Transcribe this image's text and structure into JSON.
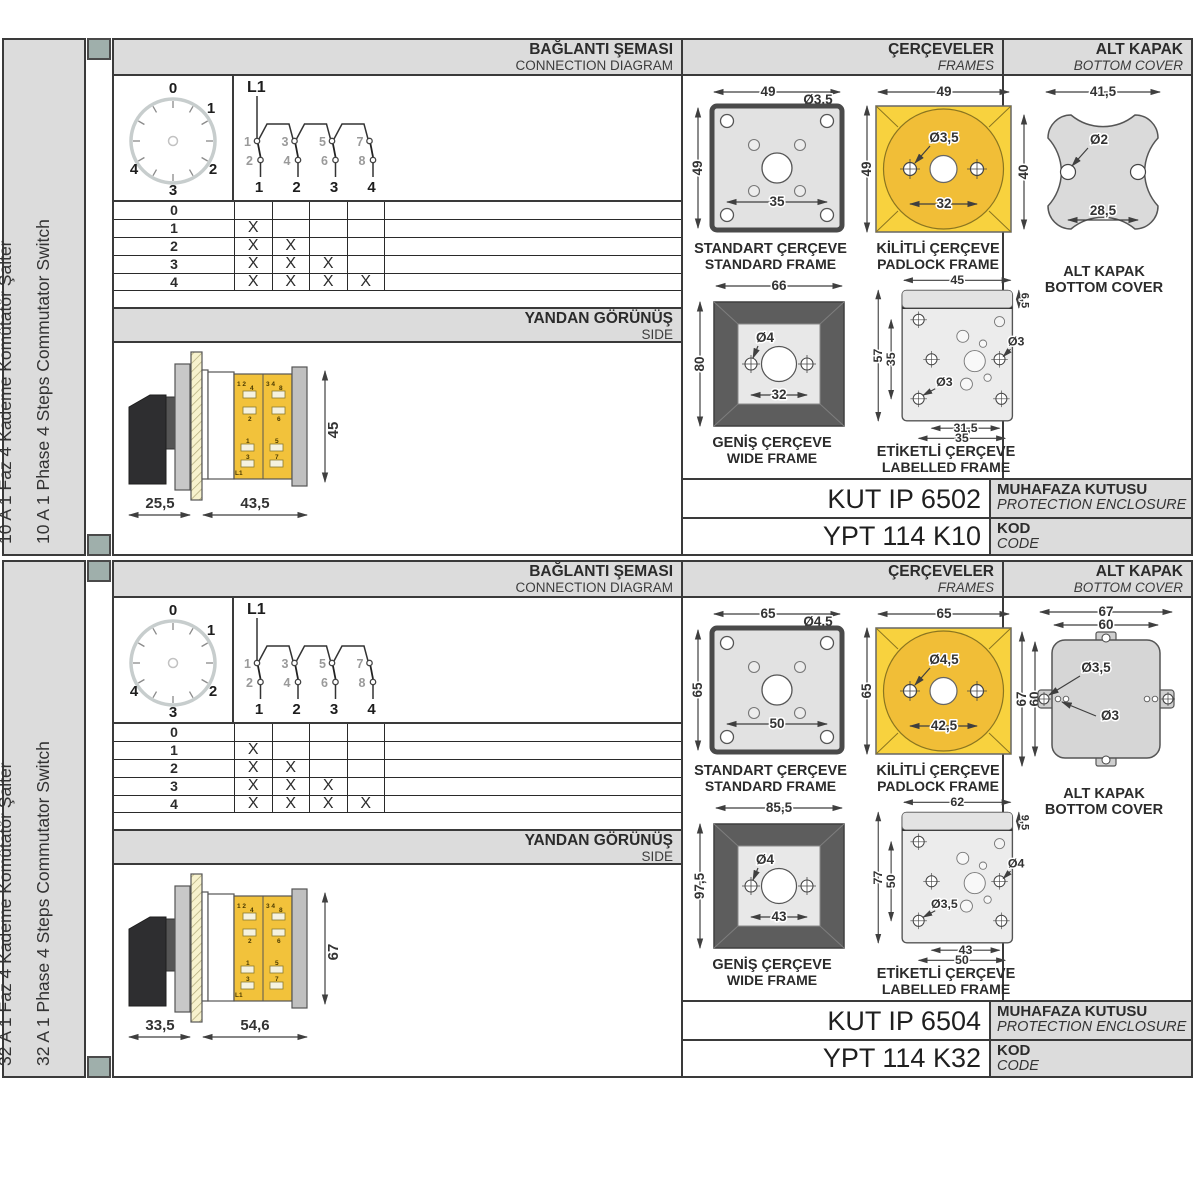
{
  "colors": {
    "accent_yellow": "#F2C23B",
    "padlock_yellow": "#F8D23E",
    "panel_gray": "#DCDCDC",
    "frame_dark_gray": "#5D5D5D",
    "spine_green": "#9FAFAB",
    "line_dark": "#3A3A3A"
  },
  "sections": [
    {
      "sidebar": {
        "title_tr": "10 A 1 Faz 4 Kademe Komütatör Şalter",
        "title_en": "10 A 1 Phase 4 Steps Commutator Switch"
      },
      "headers": {
        "connection_tr": "BAĞLANTI ŞEMASI",
        "connection_en": "CONNECTION DIAGRAM",
        "side_tr": "YANDAN GÖRÜNÜŞ",
        "side_en": "SIDE",
        "frames_tr": "ÇERÇEVELER",
        "frames_en": "FRAMES",
        "cover_tr": "ALT KAPAK",
        "cover_en": "BOTTOM COVER"
      },
      "dial": {
        "positions": [
          "0",
          "1",
          "2",
          "3",
          "4"
        ]
      },
      "schematic": {
        "feed_label": "L1",
        "upper_terminals": [
          "1",
          "3",
          "5",
          "7"
        ],
        "lower_terminals": [
          "2",
          "4",
          "6",
          "8"
        ],
        "outputs": [
          "1",
          "2",
          "3",
          "4"
        ]
      },
      "step_table": {
        "rows": [
          {
            "step": "0",
            "contacts": [
              "",
              "",
              "",
              ""
            ]
          },
          {
            "step": "1",
            "contacts": [
              "X",
              "",
              "",
              ""
            ]
          },
          {
            "step": "2",
            "contacts": [
              "X",
              "X",
              "",
              ""
            ]
          },
          {
            "step": "3",
            "contacts": [
              "X",
              "X",
              "X",
              ""
            ]
          },
          {
            "step": "4",
            "contacts": [
              "X",
              "X",
              "X",
              "X"
            ]
          }
        ]
      },
      "side_view": {
        "depth_handle": "25,5",
        "depth_body": "43,5",
        "height": "45",
        "terminals": {
          "col1_top": "1 2",
          "col1_mid": [
            "4",
            "2"
          ],
          "col1_bot": [
            "1",
            "3"
          ],
          "col2_top": "3 4",
          "col2_mid": [
            "8",
            "6"
          ],
          "col2_bot": [
            "5",
            "7"
          ],
          "feed": "L1"
        }
      },
      "frames": {
        "standard": {
          "name_tr": "STANDART ÇERÇEVE",
          "name_en": "STANDARD FRAME",
          "width": "49",
          "height": "49",
          "hole": "Ø3,5",
          "hole_spacing": "35"
        },
        "padlock": {
          "name_tr": "KİLİTLİ ÇERÇEVE",
          "name_en": "PADLOCK FRAME",
          "width": "49",
          "height": "49",
          "hole": "Ø3,5",
          "hole_spacing": "32"
        },
        "wide": {
          "name_tr": "GENİŞ ÇERÇEVE",
          "name_en": "WIDE FRAME",
          "width": "66",
          "height": "80",
          "hole": "Ø4",
          "hole_spacing": "32"
        },
        "labelled": {
          "name_tr": "ETİKETLİ ÇERÇEVE",
          "name_en": "LABELLED FRAME",
          "width": "45",
          "strip_height": "6,5",
          "height": "57",
          "hole_span_v": "35",
          "hole_right": "Ø3",
          "hole_inner": "Ø3",
          "span_inner": "31,5",
          "span_outer": "35"
        }
      },
      "bottom_cover": {
        "variant": "clover",
        "name_tr": "ALT KAPAK",
        "name_en": "BOTTOM COVER",
        "width": "41,5",
        "height": "40",
        "hole": "Ø2",
        "hole_spacing": "28,5"
      },
      "codes": {
        "enclosure_code": "KUT IP 6502",
        "enclosure_label_tr": "MUHAFAZA KUTUSU",
        "enclosure_label_en": "PROTECTION ENCLOSURE",
        "product_code": "YPT 114 K10",
        "code_label_tr": "KOD",
        "code_label_en": "CODE"
      }
    },
    {
      "sidebar": {
        "title_tr": "32 A 1 Faz 4 Kademe Komütatör Şalter",
        "title_en": "32 A 1 Phase 4 Steps Commutator Switch"
      },
      "headers": {
        "connection_tr": "BAĞLANTI ŞEMASI",
        "connection_en": "CONNECTION DIAGRAM",
        "side_tr": "YANDAN GÖRÜNÜŞ",
        "side_en": "SIDE",
        "frames_tr": "ÇERÇEVELER",
        "frames_en": "FRAMES",
        "cover_tr": "ALT KAPAK",
        "cover_en": "BOTTOM COVER"
      },
      "dial": {
        "positions": [
          "0",
          "1",
          "2",
          "3",
          "4"
        ]
      },
      "schematic": {
        "feed_label": "L1",
        "upper_terminals": [
          "1",
          "3",
          "5",
          "7"
        ],
        "lower_terminals": [
          "2",
          "4",
          "6",
          "8"
        ],
        "outputs": [
          "1",
          "2",
          "3",
          "4"
        ]
      },
      "step_table": {
        "rows": [
          {
            "step": "0",
            "contacts": [
              "",
              "",
              "",
              ""
            ]
          },
          {
            "step": "1",
            "contacts": [
              "X",
              "",
              "",
              ""
            ]
          },
          {
            "step": "2",
            "contacts": [
              "X",
              "X",
              "",
              ""
            ]
          },
          {
            "step": "3",
            "contacts": [
              "X",
              "X",
              "X",
              ""
            ]
          },
          {
            "step": "4",
            "contacts": [
              "X",
              "X",
              "X",
              "X"
            ]
          }
        ]
      },
      "side_view": {
        "depth_handle": "33,5",
        "depth_body": "54,6",
        "height": "67",
        "terminals": {
          "col1_top": "1 2",
          "col1_mid": [
            "4",
            "2"
          ],
          "col1_bot": [
            "1",
            "3"
          ],
          "col2_top": "3 4",
          "col2_mid": [
            "8",
            "6"
          ],
          "col2_bot": [
            "5",
            "7"
          ],
          "feed": "L1"
        }
      },
      "frames": {
        "standard": {
          "name_tr": "STANDART ÇERÇEVE",
          "name_en": "STANDARD FRAME",
          "width": "65",
          "height": "65",
          "hole": "Ø4,5",
          "hole_spacing": "50"
        },
        "padlock": {
          "name_tr": "KİLİTLİ ÇERÇEVE",
          "name_en": "PADLOCK FRAME",
          "width": "65",
          "height": "65",
          "hole": "Ø4,5",
          "hole_spacing": "42,5"
        },
        "wide": {
          "name_tr": "GENİŞ ÇERÇEVE",
          "name_en": "WIDE FRAME",
          "width": "85,5",
          "height": "97,5",
          "hole": "Ø4",
          "hole_spacing": "43"
        },
        "labelled": {
          "name_tr": "ETİKETLİ ÇERÇEVE",
          "name_en": "LABELLED FRAME",
          "width": "62",
          "strip_height": "9,5",
          "height": "77",
          "hole_span_v": "50",
          "hole_right": "Ø4",
          "hole_inner": "Ø3,5",
          "span_inner": "43",
          "span_outer": "50"
        }
      },
      "bottom_cover": {
        "variant": "square",
        "name_tr": "ALT KAPAK",
        "name_en": "BOTTOM COVER",
        "outer_width": "67",
        "inner_width": "60",
        "outer_height": "67",
        "inner_height": "60",
        "hole_large": "Ø3,5",
        "hole_small": "Ø3"
      },
      "codes": {
        "enclosure_code": "KUT IP 6504",
        "enclosure_label_tr": "MUHAFAZA KUTUSU",
        "enclosure_label_en": "PROTECTION ENCLOSURE",
        "product_code": "YPT 114 K32",
        "code_label_tr": "KOD",
        "code_label_en": "CODE"
      }
    }
  ]
}
